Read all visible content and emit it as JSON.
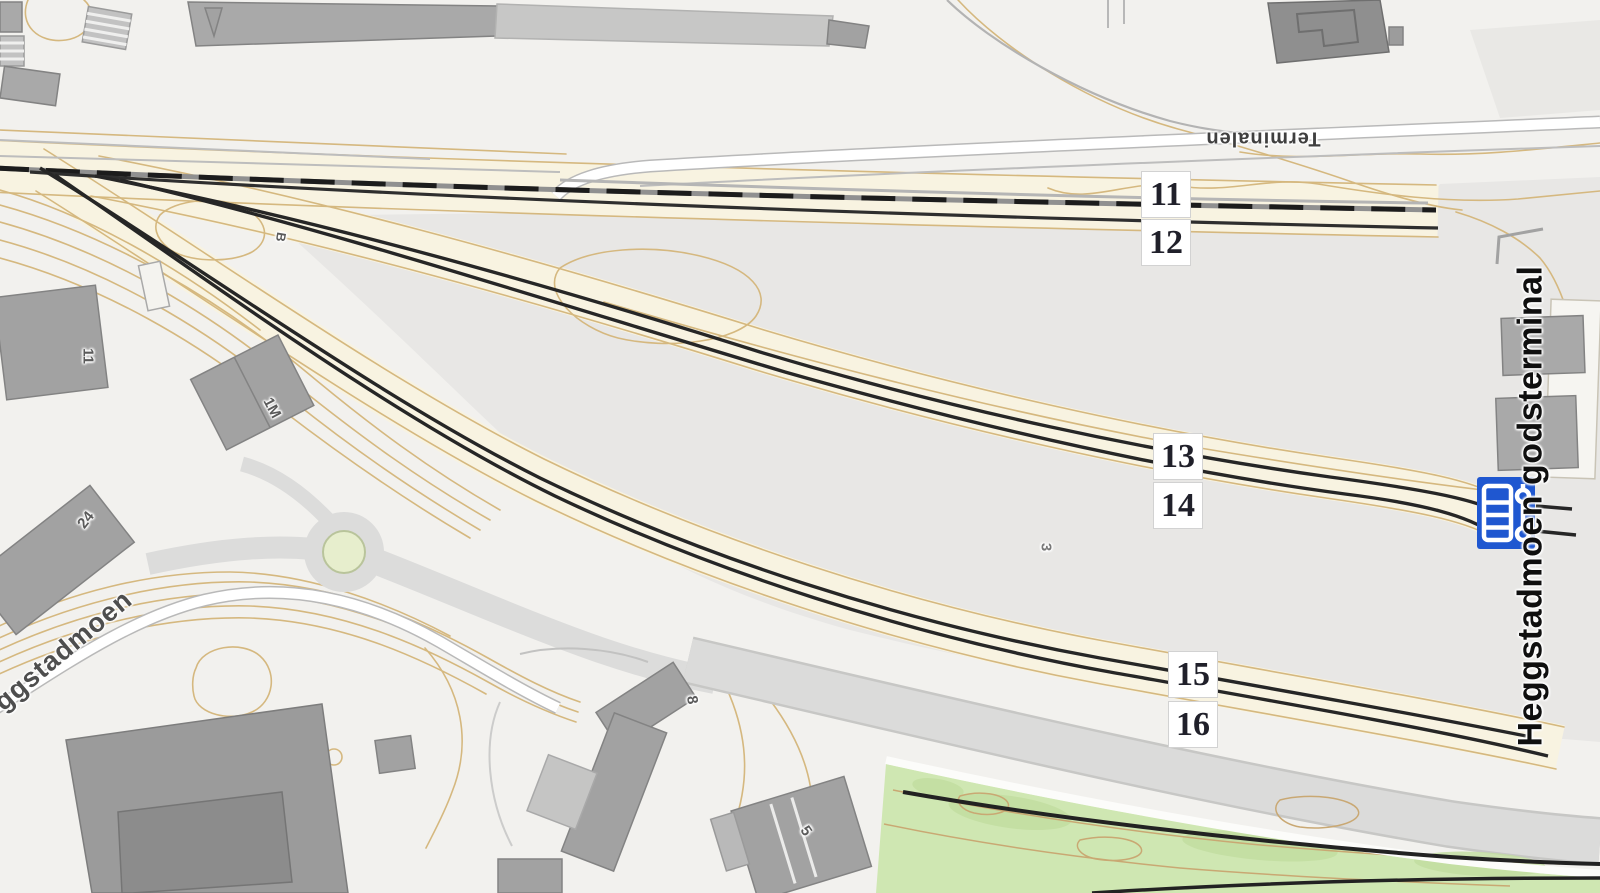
{
  "map": {
    "track_labels": [
      {
        "id": "track-11",
        "text": "11"
      },
      {
        "id": "track-12",
        "text": "12"
      },
      {
        "id": "track-13",
        "text": "13"
      },
      {
        "id": "track-14",
        "text": "14"
      },
      {
        "id": "track-15",
        "text": "15"
      },
      {
        "id": "track-16",
        "text": "16"
      }
    ],
    "place_labels": {
      "terminal_name": "Heggstadmoen godsterminal",
      "street_terminalen": "Terminalen",
      "street_heggstadmoen": "ggstadmoen"
    },
    "building_numbers": [
      {
        "text": "11"
      },
      {
        "text": "B"
      },
      {
        "text": "1M"
      },
      {
        "text": "24"
      },
      {
        "text": "8"
      },
      {
        "text": "5"
      },
      {
        "text": "3"
      }
    ],
    "markers": {
      "freight_terminal_icon": "railway-loading-terminal-marker"
    },
    "colors": {
      "background": "#f2f1ee",
      "terminal_area": "#e8e7e5",
      "track_corridor": "#f8f3e1",
      "contour_line": "#d5b87f",
      "building": "#a2a2a2",
      "road": "#dbdbda",
      "green_area": "#cfe7b2",
      "track_line": "#222222",
      "marker_blue": "#1f57d0",
      "label_text": "#20202a"
    }
  }
}
